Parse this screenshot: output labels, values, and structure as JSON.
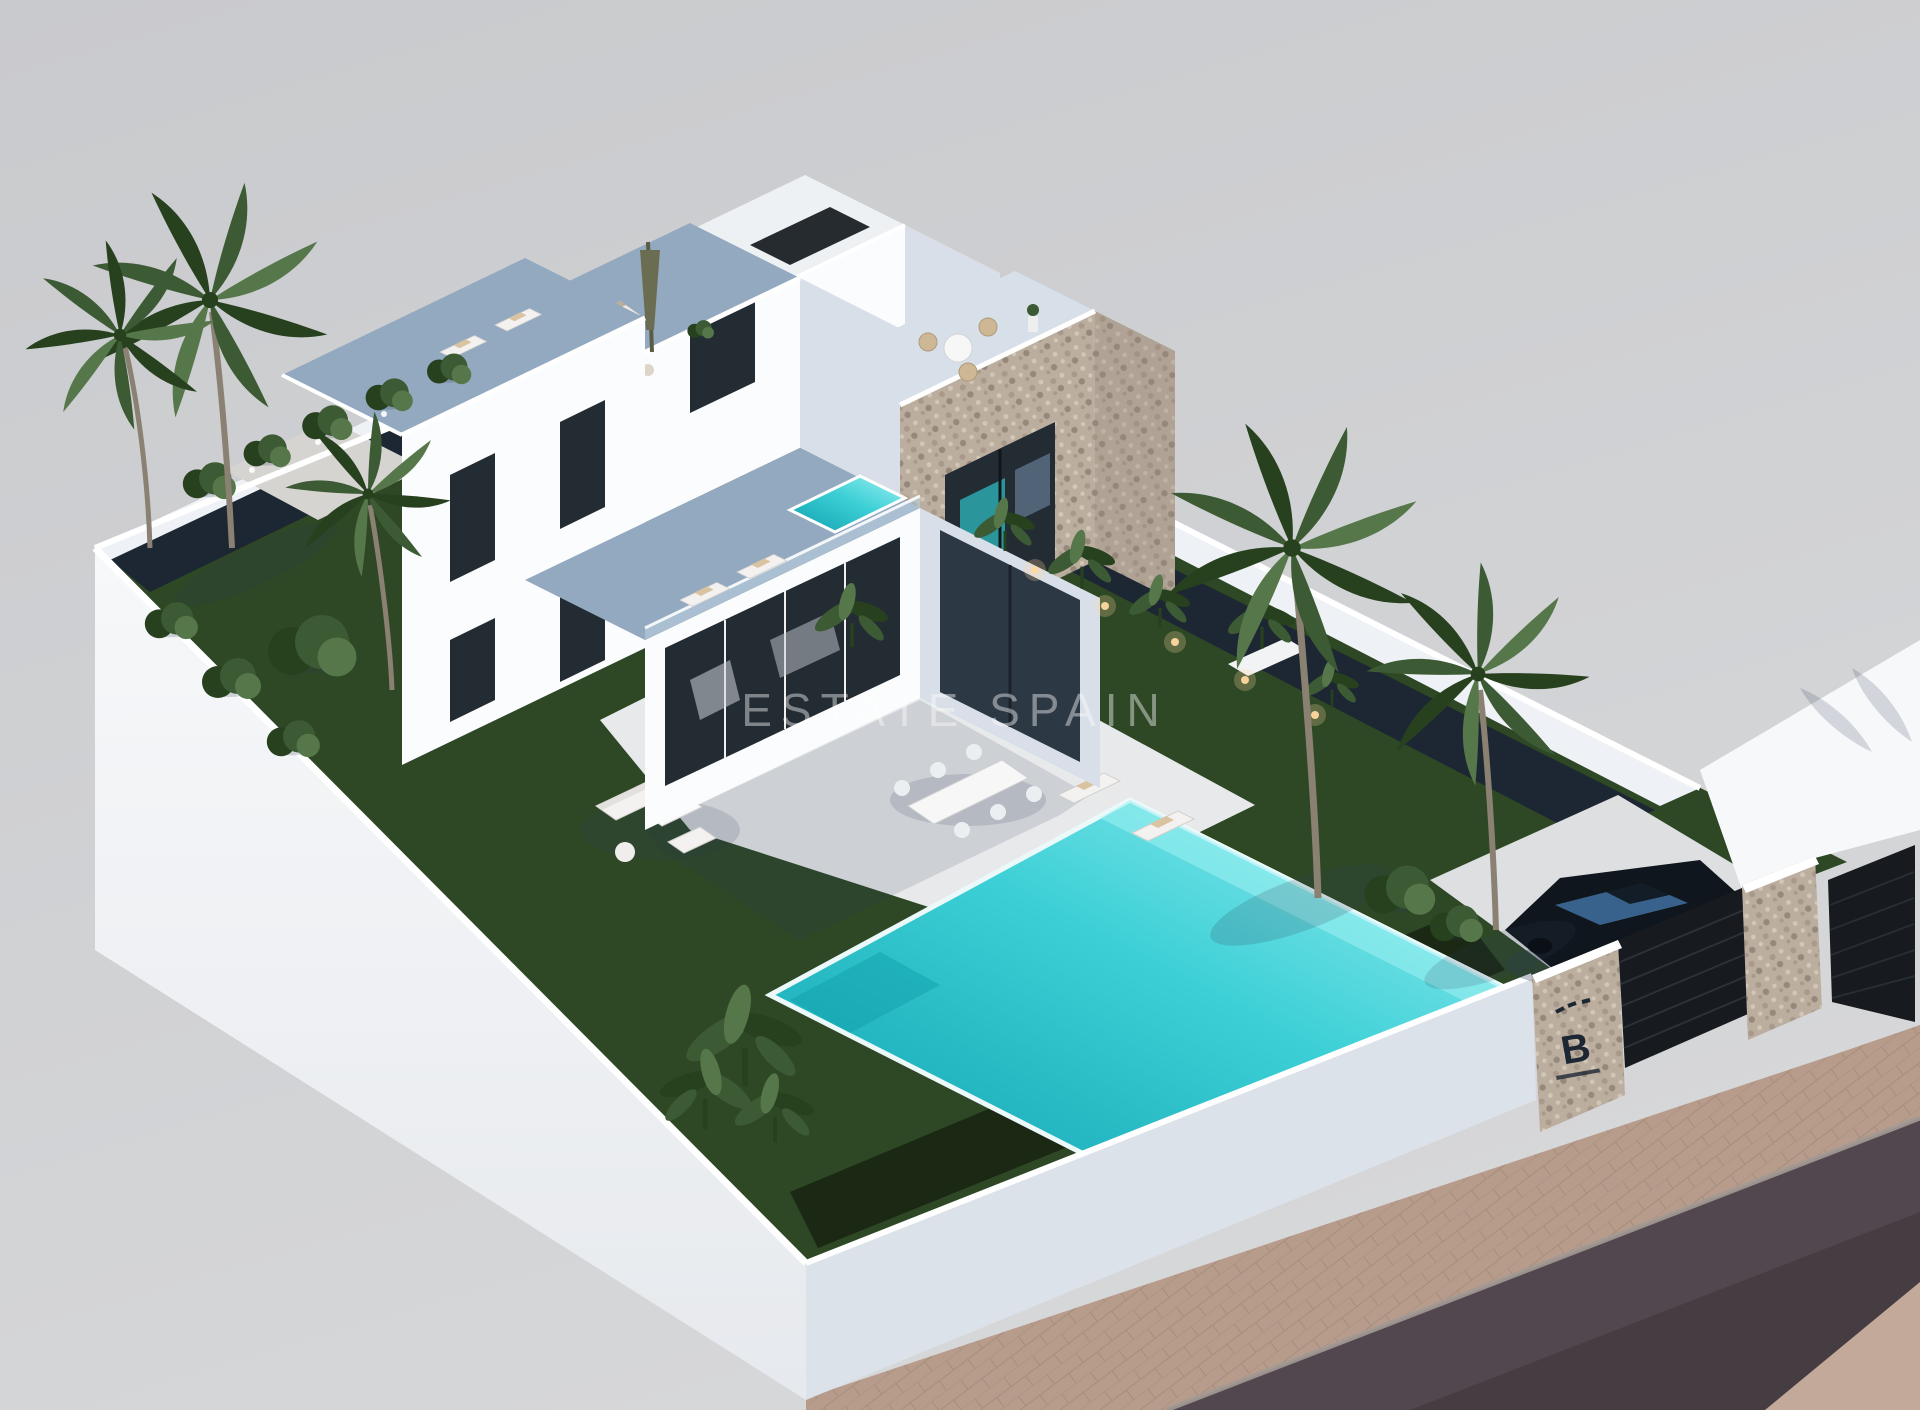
{
  "scene": {
    "type": "3d-architectural-render",
    "view": "aerial three-quarter",
    "subject": "Modern two-storey white villa with rooftop terraces, stone-clad tower, walled garden plot, private turquoise pool, gated driveway with parked car, palm trees, paver sidewalk and street",
    "watermark": "ESTATE SPAIN",
    "entrance_sign": {
      "letter": "B"
    }
  },
  "colors": {
    "bg": "#c9cacd",
    "bg2": "#d6d7d9",
    "road": "#52474e",
    "road2": "#463d43",
    "walkway": "#b79c8c",
    "walk_line": "#9f8774",
    "walk_corner": "#c3a999",
    "curb": "#a39a94",
    "wall": "#f7f8fa",
    "wall_lo": "#e6e9ed",
    "wall_se": "#dce2e9",
    "wall_top": "#ffffff",
    "wall_inner": "#eef1f5",
    "lawn": "#2e4826",
    "bed": "#1d2733",
    "hedge": "#1a2814",
    "patio": "#e8e9ea",
    "path": "#d6d4d1",
    "drive": "#dedfe1",
    "pool_l": "#9ff0f2",
    "pool_m": "#3cd0d6",
    "pool_d": "#0f9fae",
    "pool_rim": "#ecf9fa",
    "house": "#fbfcfd",
    "house_se": "#d8dfe8",
    "roof": "#eef1f4",
    "terrace": "#93a9c0",
    "balustrade": "#b9cede",
    "stone": "#bcae9f",
    "stone_hi": "#d2c6b7",
    "stone_lo": "#96897b",
    "stone_mid": "#a9998a",
    "window": "#232b33",
    "glass": "#2d3845",
    "glass_hi": "#7f9cba",
    "teal_glint": "#2fb9c0",
    "green": "#3c5a33",
    "green_d": "#27411f",
    "green_l": "#55774a",
    "trunk": "#8b8172",
    "car": "#10161d",
    "car_hi": "#3f6f9f",
    "gate": "#171a1f",
    "gate_slat": "#343a42",
    "logo": "#1d2633",
    "shadow": "#2c3c55",
    "torch": "#ffd9a0",
    "furn": "#f3f2f0",
    "furn_line": "#d2d0cc",
    "cushion": "#d9c3a0",
    "wm": "#ffffff"
  }
}
